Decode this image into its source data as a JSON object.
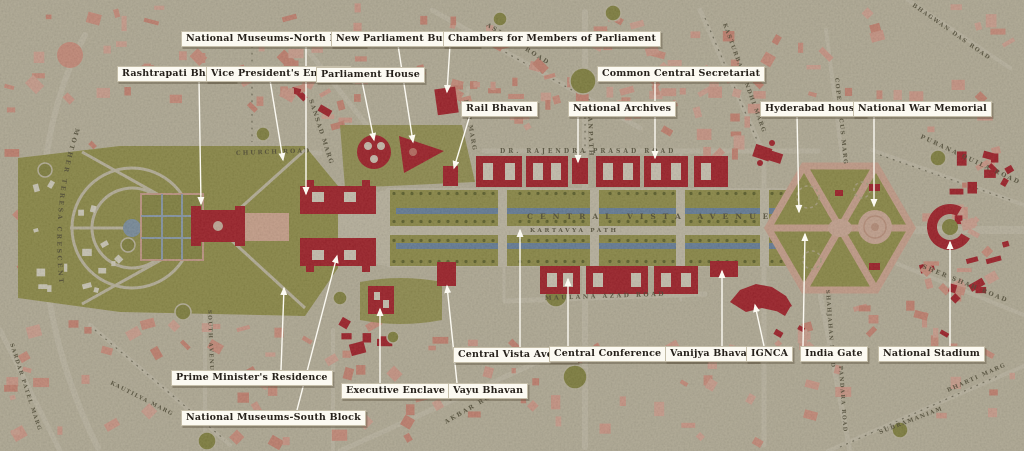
{
  "map": {
    "title": "Central Vista New Delhi annotated map",
    "avenue_text": "CENTRAL VISTA AVENUE",
    "path_text": "KARTAVYA PATH"
  },
  "colors": {
    "background": "#d4cdb6",
    "road": "#ded7c2",
    "city_block_pink": "#eba593",
    "landmark_red": "#bb2330",
    "lawn_olive": "#a5a356",
    "water_blue": "#7694b7",
    "hexagon_road_pink": "#e9bba6",
    "plaza_pink": "#eac2ae",
    "label_bg": "#fcfaf2",
    "label_text": "#26211b",
    "street_text": "#514d3a",
    "leader_line": "#fcfaf2"
  },
  "labels": [
    {
      "id": "rashtrapati-bhavan",
      "text": "Rashtrapati Bhavan",
      "box": [
        117,
        66
      ],
      "line": [
        [
          199,
          80
        ],
        [
          201,
          204
        ]
      ]
    },
    {
      "id": "vice-presidents-enclave",
      "text": "Vice President's Enclave",
      "box": [
        206,
        66
      ],
      "line": [
        [
          270,
          80
        ],
        [
          283,
          160
        ]
      ]
    },
    {
      "id": "national-museums-north-block",
      "text": "National Museums-North Block",
      "box": [
        181,
        31
      ],
      "line": [
        [
          306,
          45
        ],
        [
          306,
          194
        ]
      ]
    },
    {
      "id": "new-parliament-building",
      "text": "New Parliament Building",
      "box": [
        331,
        31
      ],
      "line": [
        [
          398,
          45
        ],
        [
          413,
          142
        ]
      ]
    },
    {
      "id": "parliament-house",
      "text": "Parliament House",
      "box": [
        316,
        67
      ],
      "line": [
        [
          362,
          81
        ],
        [
          374,
          140
        ]
      ]
    },
    {
      "id": "chambers-for-members-of-parliament",
      "text": "Chambers for Members of Parliament",
      "box": [
        443,
        31
      ],
      "line": [
        [
          450,
          45
        ],
        [
          447,
          92
        ]
      ]
    },
    {
      "id": "rail-bhavan",
      "text": "Rail Bhavan",
      "box": [
        461,
        101
      ],
      "line": [
        [
          470,
          115
        ],
        [
          454,
          168
        ]
      ]
    },
    {
      "id": "national-archives",
      "text": "National Archives",
      "box": [
        568,
        101
      ],
      "line": [
        [
          578,
          115
        ],
        [
          578,
          162
        ]
      ]
    },
    {
      "id": "common-central-secretariat",
      "text": "Common Central Secretariat",
      "box": [
        597,
        66
      ],
      "line": [
        [
          655,
          80
        ],
        [
          655,
          158
        ]
      ]
    },
    {
      "id": "hyderabad-house",
      "text": "Hyderabad house",
      "box": [
        760,
        101
      ],
      "line": [
        [
          797,
          115
        ],
        [
          799,
          212
        ]
      ]
    },
    {
      "id": "national-war-memorial",
      "text": "National War Memorial",
      "box": [
        853,
        101
      ],
      "line": [
        [
          874,
          115
        ],
        [
          874,
          206
        ]
      ]
    },
    {
      "id": "central-vista-avenue",
      "text": "Central Vista Avenue",
      "box": [
        453,
        347
      ],
      "line": [
        [
          520,
          347
        ],
        [
          520,
          230
        ]
      ]
    },
    {
      "id": "central-conference-centre",
      "text": "Central Conference Centre",
      "box": [
        549,
        346
      ],
      "line": [
        [
          568,
          346
        ],
        [
          568,
          279
        ]
      ]
    },
    {
      "id": "vanijya-bhavan",
      "text": "Vanijya Bhavan",
      "box": [
        665,
        346
      ],
      "line": [
        [
          722,
          346
        ],
        [
          722,
          271
        ]
      ]
    },
    {
      "id": "ignca",
      "text": "IGNCA",
      "box": [
        746,
        346
      ],
      "line": [
        [
          764,
          346
        ],
        [
          755,
          305
        ]
      ]
    },
    {
      "id": "india-gate",
      "text": "India Gate",
      "box": [
        800,
        346
      ],
      "line": [
        [
          803,
          346
        ],
        [
          805,
          234
        ]
      ]
    },
    {
      "id": "national-stadium",
      "text": "National Stadium",
      "box": [
        878,
        346
      ],
      "line": [
        [
          950,
          346
        ],
        [
          950,
          242
        ]
      ]
    },
    {
      "id": "prime-ministers-residence",
      "text": "Prime Minister's Residence",
      "box": [
        171,
        370
      ],
      "line": [
        [
          281,
          370
        ],
        [
          284,
          288
        ]
      ]
    },
    {
      "id": "national-museums-south-block",
      "text": "National Museums-South Block",
      "box": [
        181,
        410
      ],
      "line": [
        [
          297,
          410
        ],
        [
          337,
          256
        ]
      ]
    },
    {
      "id": "executive-enclave",
      "text": "Executive Enclave",
      "box": [
        341,
        383
      ],
      "line": [
        [
          380,
          383
        ],
        [
          380,
          309
        ]
      ]
    },
    {
      "id": "vayu-bhavan",
      "text": "Vayu Bhavan",
      "box": [
        448,
        383
      ],
      "line": [
        [
          457,
          383
        ],
        [
          447,
          286
        ]
      ]
    }
  ],
  "streets": [
    {
      "id": "mother-teresa-crescent",
      "text": "MOTHER TERESA CRESCENT",
      "curve": true,
      "fs": 6.2,
      "s": 2.5
    },
    {
      "id": "church-road",
      "text": "CHURCH ROAD",
      "x": 236,
      "y": 155,
      "r": -2,
      "s": 2,
      "fs": 6
    },
    {
      "id": "sansad-marg",
      "text": "SANSAD MARG",
      "x": 309,
      "y": 100,
      "r": 72,
      "s": 1.5,
      "fs": 6
    },
    {
      "id": "ashoka-road",
      "text": "ASHOKA ROAD",
      "x": 486,
      "y": 26,
      "r": 32,
      "s": 2,
      "fs": 6
    },
    {
      "id": "janpath",
      "text": "JANPATH",
      "x": 588,
      "y": 112,
      "r": 88,
      "s": 2,
      "fs": 6
    },
    {
      "id": "rafi-marg",
      "text": "RAFI MARG",
      "x": 464,
      "y": 100,
      "r": 80,
      "s": 1.5,
      "fs": 5.8
    },
    {
      "id": "dr-rajendra-prasad-road",
      "text": "DR. RAJENDRA PRASAD ROAD",
      "x": 500,
      "y": 153,
      "r": 0,
      "s": 3,
      "fs": 6
    },
    {
      "id": "central-vista-avenue-text",
      "text": "CENTRAL VISTA AVENUE",
      "x": 527,
      "y": 219,
      "r": 0,
      "s": 7,
      "fs": 7.5
    },
    {
      "id": "kartavya-path-text",
      "text": "KARTAVYA PATH",
      "x": 530,
      "y": 232,
      "r": 0,
      "s": 2.6,
      "fs": 5.8
    },
    {
      "id": "maulana-azad-road",
      "text": "MAULANA AZAD ROAD",
      "x": 545,
      "y": 300,
      "r": -2,
      "s": 2.5,
      "fs": 6
    },
    {
      "id": "akbar-road",
      "text": "AKBAR ROAD",
      "x": 446,
      "y": 424,
      "r": -30,
      "s": 2,
      "fs": 6
    },
    {
      "id": "kasturba-gandhi-marg",
      "text": "KASTURBA GANDHI MARG",
      "x": 723,
      "y": 24,
      "r": 70,
      "s": 1.5,
      "fs": 5.6
    },
    {
      "id": "copernicus-marg",
      "text": "COPERNICUS MARG",
      "x": 835,
      "y": 78,
      "r": 84,
      "s": 1.5,
      "fs": 5.6
    },
    {
      "id": "bhagwan-das-road",
      "text": "BHAGWAN DAS ROAD",
      "x": 912,
      "y": 6,
      "r": 35,
      "s": 1.5,
      "fs": 5.6
    },
    {
      "id": "purana-quila-road",
      "text": "PURANA QUILA ROAD",
      "x": 920,
      "y": 138,
      "r": 25,
      "s": 2,
      "fs": 6
    },
    {
      "id": "sher-shah-road",
      "text": "SHER SHAH ROAD",
      "x": 922,
      "y": 268,
      "r": 22,
      "s": 2,
      "fs": 6
    },
    {
      "id": "shahjahan-road",
      "text": "SHAHJAHAN ROAD",
      "x": 826,
      "y": 290,
      "r": 86,
      "s": 1.4,
      "fs": 5.4
    },
    {
      "id": "pandara-road",
      "text": "PANDARA ROAD",
      "x": 839,
      "y": 366,
      "r": 86,
      "s": 1.4,
      "fs": 5.4
    },
    {
      "id": "subramaniam",
      "text": "SUBRAMANIAM",
      "x": 880,
      "y": 434,
      "r": -21,
      "s": 1.5,
      "fs": 5.6
    },
    {
      "id": "bharti-marg",
      "text": "BHARTI MARG",
      "x": 948,
      "y": 392,
      "r": -24,
      "s": 1.5,
      "fs": 5.6
    },
    {
      "id": "sardar-patel-marg",
      "text": "SARDAR PATEL MARG",
      "x": 10,
      "y": 344,
      "r": 72,
      "s": 1.4,
      "fs": 5.4
    },
    {
      "id": "kautilya-marg",
      "text": "KAUTILYA MARG",
      "x": 110,
      "y": 384,
      "r": 27,
      "s": 1.4,
      "fs": 5.4
    },
    {
      "id": "south-avenue",
      "text": "SOUTH AVENUE",
      "x": 208,
      "y": 310,
      "r": 88,
      "s": 1.4,
      "fs": 5.4
    }
  ]
}
